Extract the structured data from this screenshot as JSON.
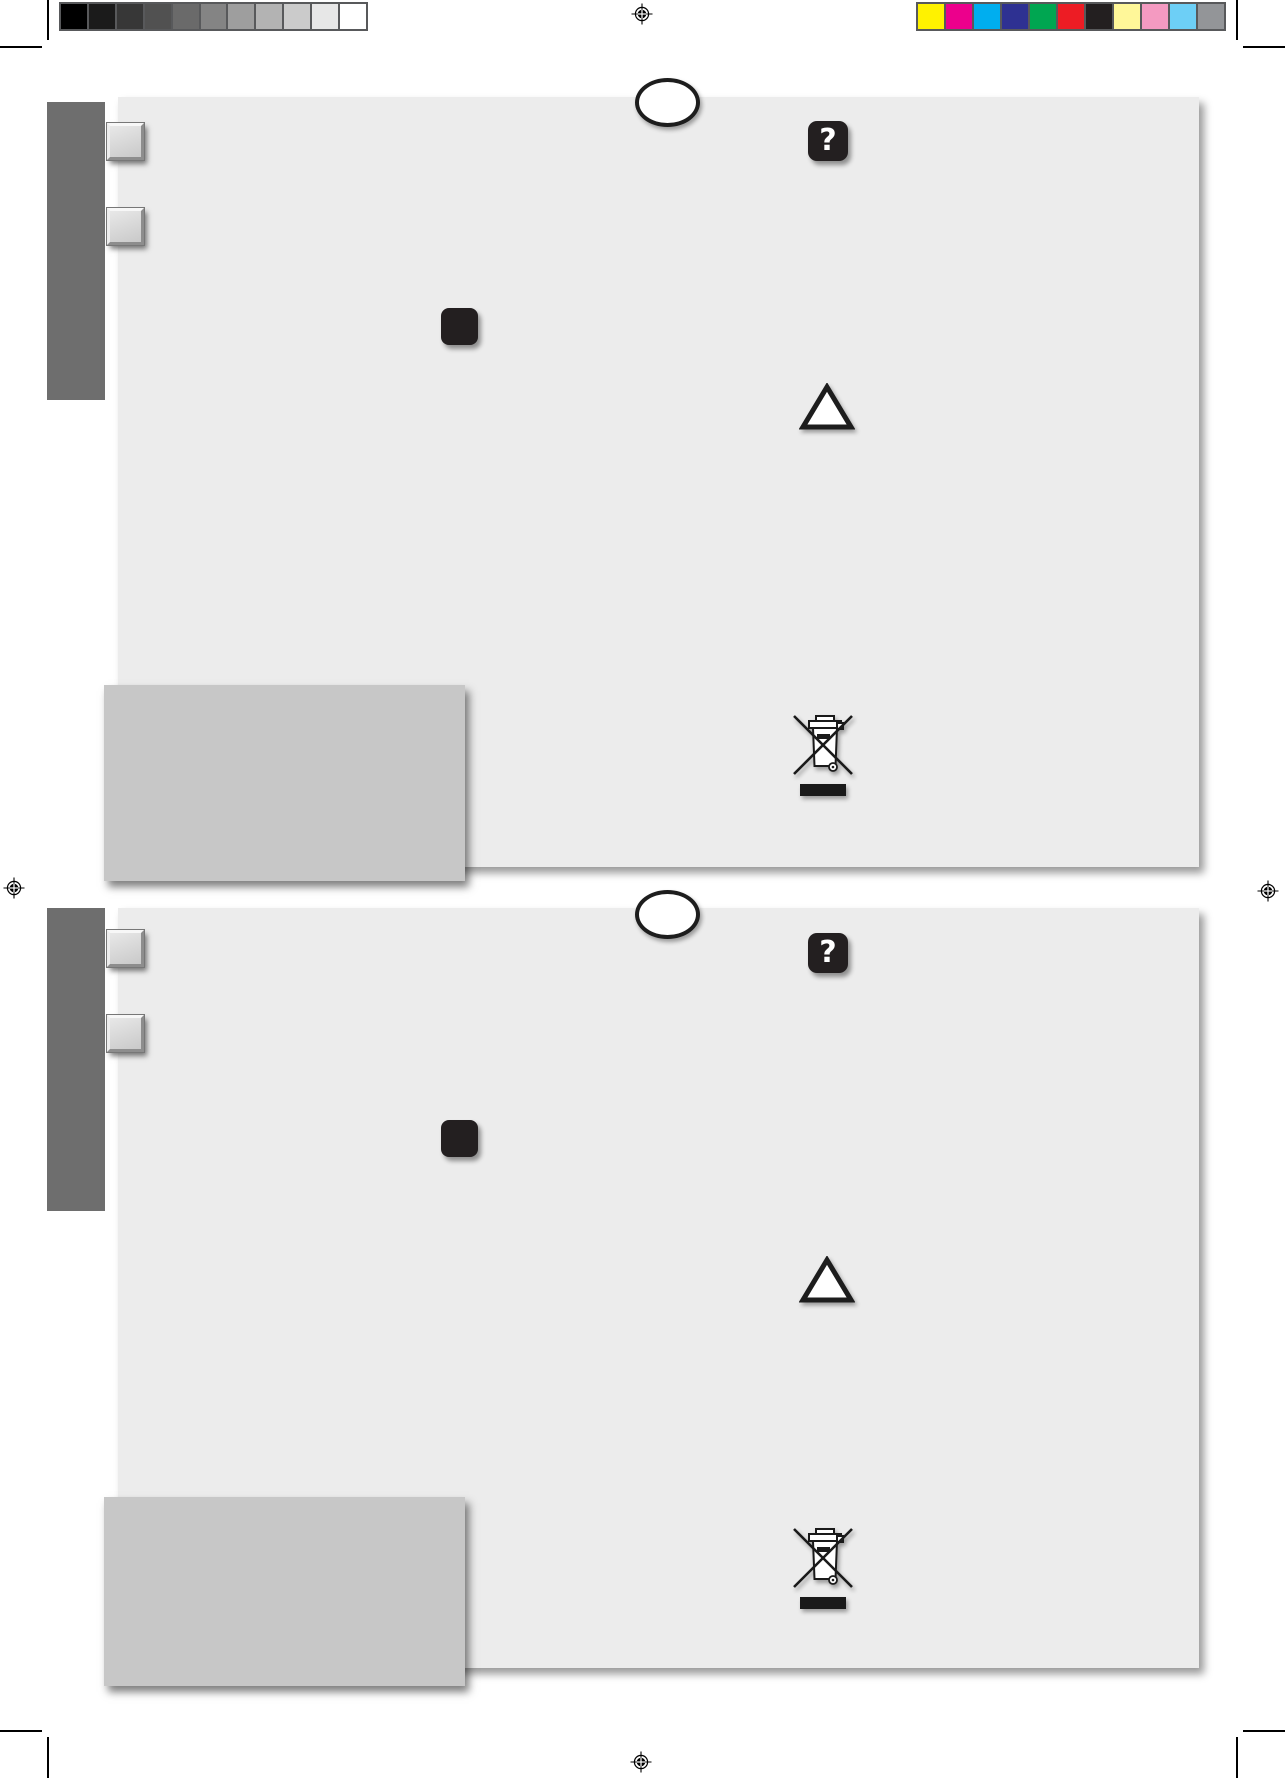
{
  "document": {
    "type": "print-press-proof-sheet",
    "pages": [
      {
        "name": "leaflet-page-top"
      },
      {
        "name": "leaflet-page-bottom"
      }
    ]
  },
  "icons": {
    "help_glyph": "?",
    "warning_icon": "triangle-outline",
    "weee_icon": "crossed-out-wheeled-bin",
    "registration_mark": "crosshair-target",
    "oval_placeholder": "ellipse-outline"
  },
  "calibration": {
    "grayscale_bar": [
      "#000000",
      "#1B1B1B",
      "#373737",
      "#515151",
      "#6A6A6A",
      "#848484",
      "#9E9E9E",
      "#B3B3B3",
      "#CBCBCB",
      "#E7E7E7",
      "#FFFFFF"
    ],
    "color_bar": [
      "#FFF200",
      "#EC008C",
      "#00AEEF",
      "#2E3192",
      "#00A651",
      "#ED1C24",
      "#231F20",
      "#FFF799",
      "#F49AC1",
      "#6DCFF6",
      "#939598"
    ],
    "bar_border": "#58595B"
  },
  "theme": {
    "page_bg": "#FFFFFF",
    "panel_bg": "#ECECEC",
    "sidebar_bg": "#6E6E6E",
    "note_box_bg": "#C7C7C7",
    "icon_dark": "#231F20",
    "mark_color": "#000000"
  }
}
